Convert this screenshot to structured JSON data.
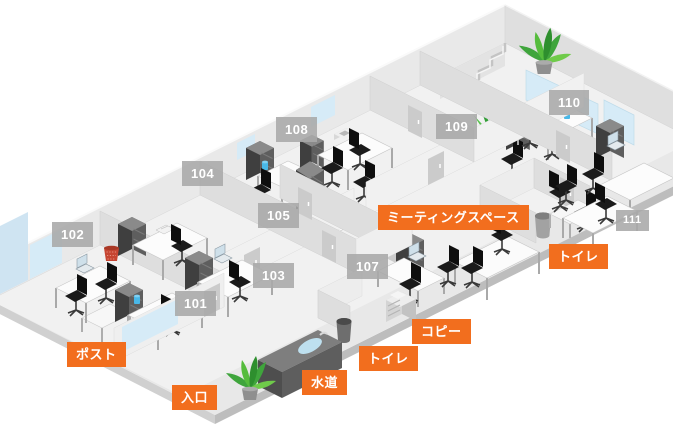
{
  "map": {
    "type": "office-floor-plan-isometric",
    "colors": {
      "room_label_bg": "rgba(168,168,168,0.88)",
      "facility_label_bg": "#F26E1E",
      "label_text": "#FFFFFF",
      "floor": "#E8E8E8",
      "wall": "#E9E9E9",
      "glass": "#D6EBF7",
      "plant_green": "#55BC3C",
      "basket_red": "#C64532",
      "cup_blue": "#49B8E8"
    },
    "rooms": [
      {
        "id": "101",
        "label": "101",
        "x": 175,
        "y": 291
      },
      {
        "id": "102",
        "label": "102",
        "x": 52,
        "y": 222
      },
      {
        "id": "103",
        "label": "103",
        "x": 253,
        "y": 263
      },
      {
        "id": "104",
        "label": "104",
        "x": 182,
        "y": 161
      },
      {
        "id": "105",
        "label": "105",
        "x": 258,
        "y": 203
      },
      {
        "id": "107",
        "label": "107",
        "x": 347,
        "y": 254
      },
      {
        "id": "108",
        "label": "108",
        "x": 276,
        "y": 117
      },
      {
        "id": "109",
        "label": "109",
        "x": 436,
        "y": 114
      },
      {
        "id": "110",
        "label": "110",
        "x": 549,
        "y": 90
      },
      {
        "id": "111",
        "label": "111",
        "x": 616,
        "y": 210,
        "small": true
      }
    ],
    "facilities": [
      {
        "id": "meeting-space",
        "label": "ミーティングスペース",
        "x": 378,
        "y": 205
      },
      {
        "id": "toilet-east",
        "label": "トイレ",
        "x": 549,
        "y": 244
      },
      {
        "id": "copy",
        "label": "コピー",
        "x": 412,
        "y": 319
      },
      {
        "id": "toilet-south",
        "label": "トイレ",
        "x": 359,
        "y": 346
      },
      {
        "id": "water",
        "label": "水道",
        "x": 302,
        "y": 370
      },
      {
        "id": "entrance",
        "label": "入口",
        "x": 172,
        "y": 385
      },
      {
        "id": "post",
        "label": "ポスト",
        "x": 67,
        "y": 342
      }
    ],
    "scene_objects": [
      "desk",
      "office-chair",
      "storage-cabinet",
      "laptop",
      "potted-plant",
      "aloe-plant",
      "copier-machine",
      "sink-counter",
      "trash-can",
      "red-mesh-basket",
      "water-cup",
      "stairs",
      "meeting-table",
      "door",
      "window-glass"
    ]
  }
}
